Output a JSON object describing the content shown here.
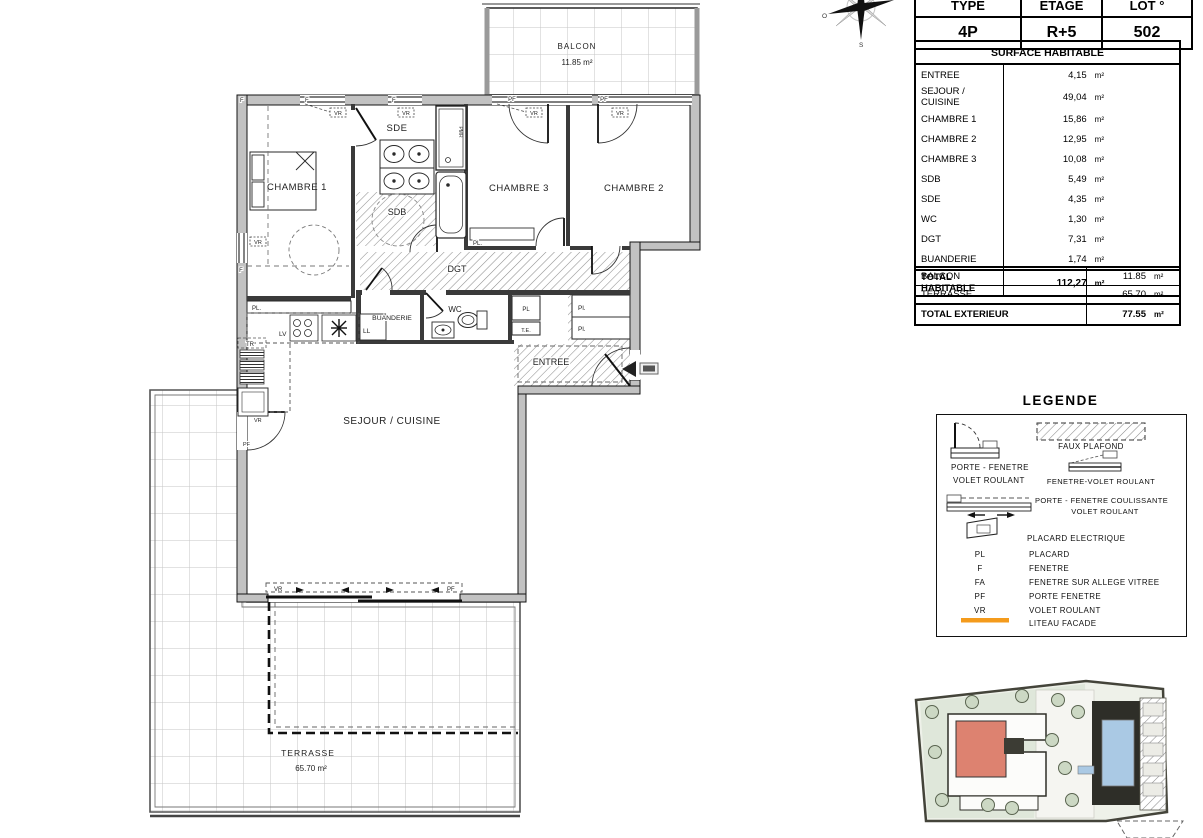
{
  "lot_table": {
    "headers": [
      {
        "label": "TYPE",
        "value": "4P"
      },
      {
        "label": "ETAGE",
        "value": "R+5"
      },
      {
        "label": "LOT °",
        "value": "502"
      }
    ],
    "section_title": "SURFACE HABITABLE",
    "rows": [
      {
        "name": "ENTREE",
        "value": "4,15",
        "unit": "m²"
      },
      {
        "name": "SEJOUR / CUISINE",
        "value": "49,04",
        "unit": "m²"
      },
      {
        "name": "CHAMBRE 1",
        "value": "15,86",
        "unit": "m²"
      },
      {
        "name": "CHAMBRE 2",
        "value": "12,95",
        "unit": "m²"
      },
      {
        "name": "CHAMBRE 3",
        "value": "10,08",
        "unit": "m²"
      },
      {
        "name": "SDB",
        "value": "5,49",
        "unit": "m²"
      },
      {
        "name": "SDE",
        "value": "4,35",
        "unit": "m²"
      },
      {
        "name": "WC",
        "value": "1,30",
        "unit": "m²"
      },
      {
        "name": "DGT",
        "value": "7,31",
        "unit": "m²"
      },
      {
        "name": "BUANDERIE",
        "value": "1,74",
        "unit": "m²"
      }
    ],
    "total": {
      "name": "TOTAL HABITABLE",
      "value": "112,27",
      "unit": "m²"
    }
  },
  "exterior_table": {
    "rows": [
      {
        "name": "BALCON",
        "value": "11.85",
        "unit": "m²"
      },
      {
        "name": "TERRASSE",
        "value": "65.70",
        "unit": "m²"
      }
    ],
    "total": {
      "name": "TOTAL EXTERIEUR",
      "value": "77.55",
      "unit": "m²"
    }
  },
  "legend": {
    "title": "LEGENDE",
    "porte_fenetre_line1": "PORTE - FENETRE",
    "porte_fenetre_line2": "VOLET ROULANT",
    "faux_plafond": "FAUX PLAFOND",
    "fenetre_volet": "FENETRE-VOLET ROULANT",
    "coulissante_line1": "PORTE - FENETRE COULISSANTE",
    "coulissante_line2": "VOLET ROULANT",
    "placard_electrique": "PLACARD ELECTRIQUE",
    "abbreviations": [
      {
        "key": "PL",
        "label": "PLACARD"
      },
      {
        "key": "F",
        "label": "FENETRE"
      },
      {
        "key": "FA",
        "label": "FENETRE SUR ALLEGE VITREE"
      },
      {
        "key": "PF",
        "label": "PORTE FENETRE"
      },
      {
        "key": "VR",
        "label": "VOLET ROULANT"
      }
    ],
    "liteau_facade": "LITEAU FACADE"
  },
  "compass": {
    "west": "O",
    "south": "S"
  },
  "plan": {
    "rooms": {
      "balcon": {
        "name": "BALCON",
        "area": "11.85 m²"
      },
      "terrasse": {
        "name": "TERRASSE",
        "area": "65.70 m²"
      },
      "chambre1": "CHAMBRE 1",
      "chambre2": "CHAMBRE 2",
      "chambre3": "CHAMBRE 3",
      "sde": "SDE",
      "sdb": "SDB",
      "dgt": "DGT",
      "wc": "WC",
      "buanderie": "BUANDERIE",
      "entree": "ENTREE",
      "sejour": "SEJOUR / CUISINE"
    },
    "tags": {
      "f": "F",
      "pf": "PF",
      "vr": "VR",
      "pl_dot": "PL.",
      "pl": "PL",
      "pl_cap": "Pl.",
      "te": "T.E.",
      "tr": "TR",
      "lv": "LV",
      "ll": "LL",
      "pmr": "PMR"
    }
  },
  "colors": {
    "liteau": "#f49b1c",
    "site_unit_highlight": "#dd8270",
    "site_pool": "#aac9e4",
    "site_green": "#dfe7da"
  }
}
